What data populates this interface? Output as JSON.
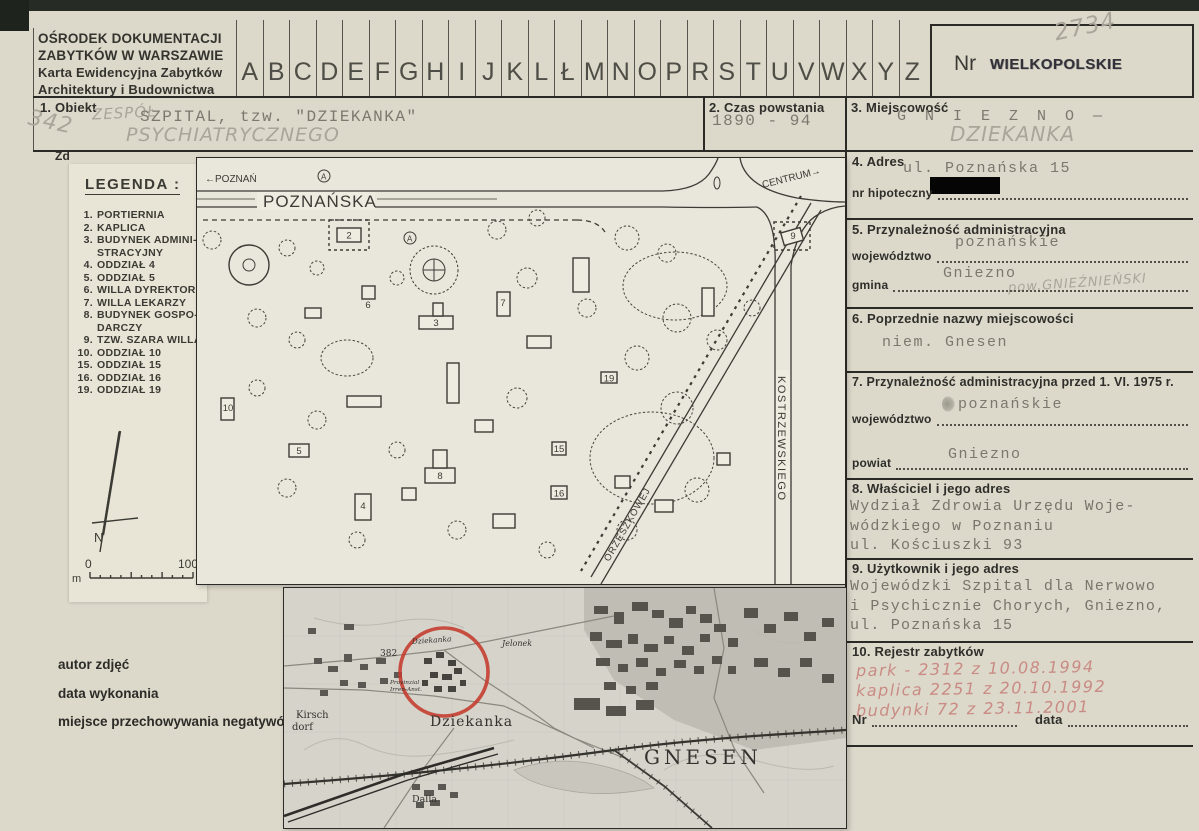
{
  "card": {
    "institution_lines": [
      "OŚRODEK DOKUMENTACJI",
      "ZABYTKÓW W WARSZAWIE",
      "Karta Ewidencyjna Zabytków",
      "Architektury i Budownictwa"
    ],
    "alphabet": [
      "A",
      "B",
      "C",
      "D",
      "E",
      "F",
      "G",
      "H",
      "I",
      "J",
      "K",
      "L",
      "Ł",
      "M",
      "N",
      "O",
      "P",
      "R",
      "S",
      "T",
      "U",
      "V",
      "W",
      "X",
      "Y",
      "Z"
    ],
    "nr_label": "Nr",
    "stamp": "WIELKOPOLSKIE",
    "nr_pencil": "2734"
  },
  "s1": {
    "label": "1. Obiekt",
    "margin_pencil": "342",
    "hand_prefix": "ZESPÓŁ",
    "typed": "SZPITAL, tzw. \"DZIEKANKA\"",
    "hand_below": "PSYCHIATRYCZNEGO"
  },
  "s2": {
    "label": "2. Czas powstania",
    "typed": "1890 - 94"
  },
  "s3": {
    "label": "3. Miejscowość",
    "typed": "G N I E Z N O —",
    "hand": "DZIEKANKA"
  },
  "s4": {
    "label": "4. Adres",
    "typed": "ul. Poznańska 15",
    "line_label": "nr hipoteczny"
  },
  "s5": {
    "label": "5. Przynależność administracyjna",
    "wojewodztwo_typed": "poznańskie",
    "wojewodztwo_label": "województwo",
    "gmina_typed": "Gniezno",
    "gmina_pencil": "pow.GNIEŹNIEŃSKI",
    "gmina_label": "gmina"
  },
  "s6": {
    "label": "6. Poprzednie nazwy miejscowości",
    "typed": "niem. Gnesen"
  },
  "s7": {
    "label": "7. Przynależność administracyjna przed 1. VI. 1975 r.",
    "wojewodztwo_typed": "poznańskie",
    "wojewodztwo_label": "województwo",
    "powiat_typed": "Gniezno",
    "powiat_label": "powiat"
  },
  "s8": {
    "label": "8. Właściciel i jego adres",
    "typed_lines": [
      "Wydział Zdrowia Urzędu Woje-",
      "wódzkiego w Poznaniu",
      "ul. Kościuszki 93"
    ]
  },
  "s9": {
    "label": "9. Użytkownik i jego adres",
    "typed_lines": [
      "Wojewódzki Szpital dla Nerwowo",
      "i Psychicznie Chorych, Gniezno,",
      "ul. Poznańska 15"
    ]
  },
  "s10": {
    "label": "10. Rejestr zabytków",
    "pencil_entries": [
      "park - 2312    z 10.08.1994",
      "kaplica 2251   z 20.10.1992",
      "budynki 72     z 23.11.2001"
    ],
    "nr_label": "Nr",
    "data_label": "data"
  },
  "photo_caption_lines": [
    "autor zdjęć",
    "data wykonania",
    "miejsce przechowywania negatywów"
  ],
  "zd_label": "Zd",
  "legend": {
    "title": "LEGENDA :",
    "items": [
      {
        "no": "1.",
        "text": "PORTIERNIA"
      },
      {
        "no": "2.",
        "text": "KAPLICA"
      },
      {
        "no": "3.",
        "text": "BUDYNEK ADMINI-\nSTRACYJNY"
      },
      {
        "no": "4.",
        "text": "ODDZIAŁ 4"
      },
      {
        "no": "5.",
        "text": "ODDZIAŁ 5"
      },
      {
        "no": "6.",
        "text": "WILLA DYREKTORA"
      },
      {
        "no": "7.",
        "text": "WILLA LEKARZY"
      },
      {
        "no": "8.",
        "text": "BUDYNEK GOSPO-\nDARCZY"
      },
      {
        "no": "9.",
        "text": "TZW. SZARA WILLA"
      },
      {
        "no": "10.",
        "text": "ODDZIAŁ 10"
      },
      {
        "no": "15.",
        "text": "ODDZIAŁ 15"
      },
      {
        "no": "16.",
        "text": "ODDZIAŁ 16"
      },
      {
        "no": "19.",
        "text": "ODDZIAŁ 19"
      }
    ],
    "north": "N",
    "scale_zero": "0",
    "scale_hundred": "100",
    "scale_unit": "m"
  },
  "site_plan": {
    "dir_west": "←POZNAŃ",
    "street_main": "POZNAŃSKA",
    "dir_east": "CENTRUM→",
    "street_right": "KOSTRZEWSKIEGO",
    "street_diag": "ORZESZKOWEJ",
    "bus_stop": "A",
    "buildings": {
      "b2": "2",
      "b3": "3",
      "b4": "4",
      "b5": "5",
      "b6": "6",
      "b7": "7",
      "b8": "8",
      "b9": "9",
      "b10": "10",
      "b15": "15",
      "b16": "16",
      "b19": "19"
    }
  },
  "city_map": {
    "road_no": "382",
    "dziekanka_small": "Dziekanka",
    "anstalt_line1": "Provinzial",
    "anstalt_line2": "Irren-Anst.",
    "dziekanka_large": "Dziekanka",
    "jelonek": "Jelonek",
    "gnesen": "GNESEN",
    "kirsch1": "Kirsch",
    "kirsch2": "dorf",
    "dalla": "Dalla",
    "highlight_color": "#c43a2c"
  }
}
